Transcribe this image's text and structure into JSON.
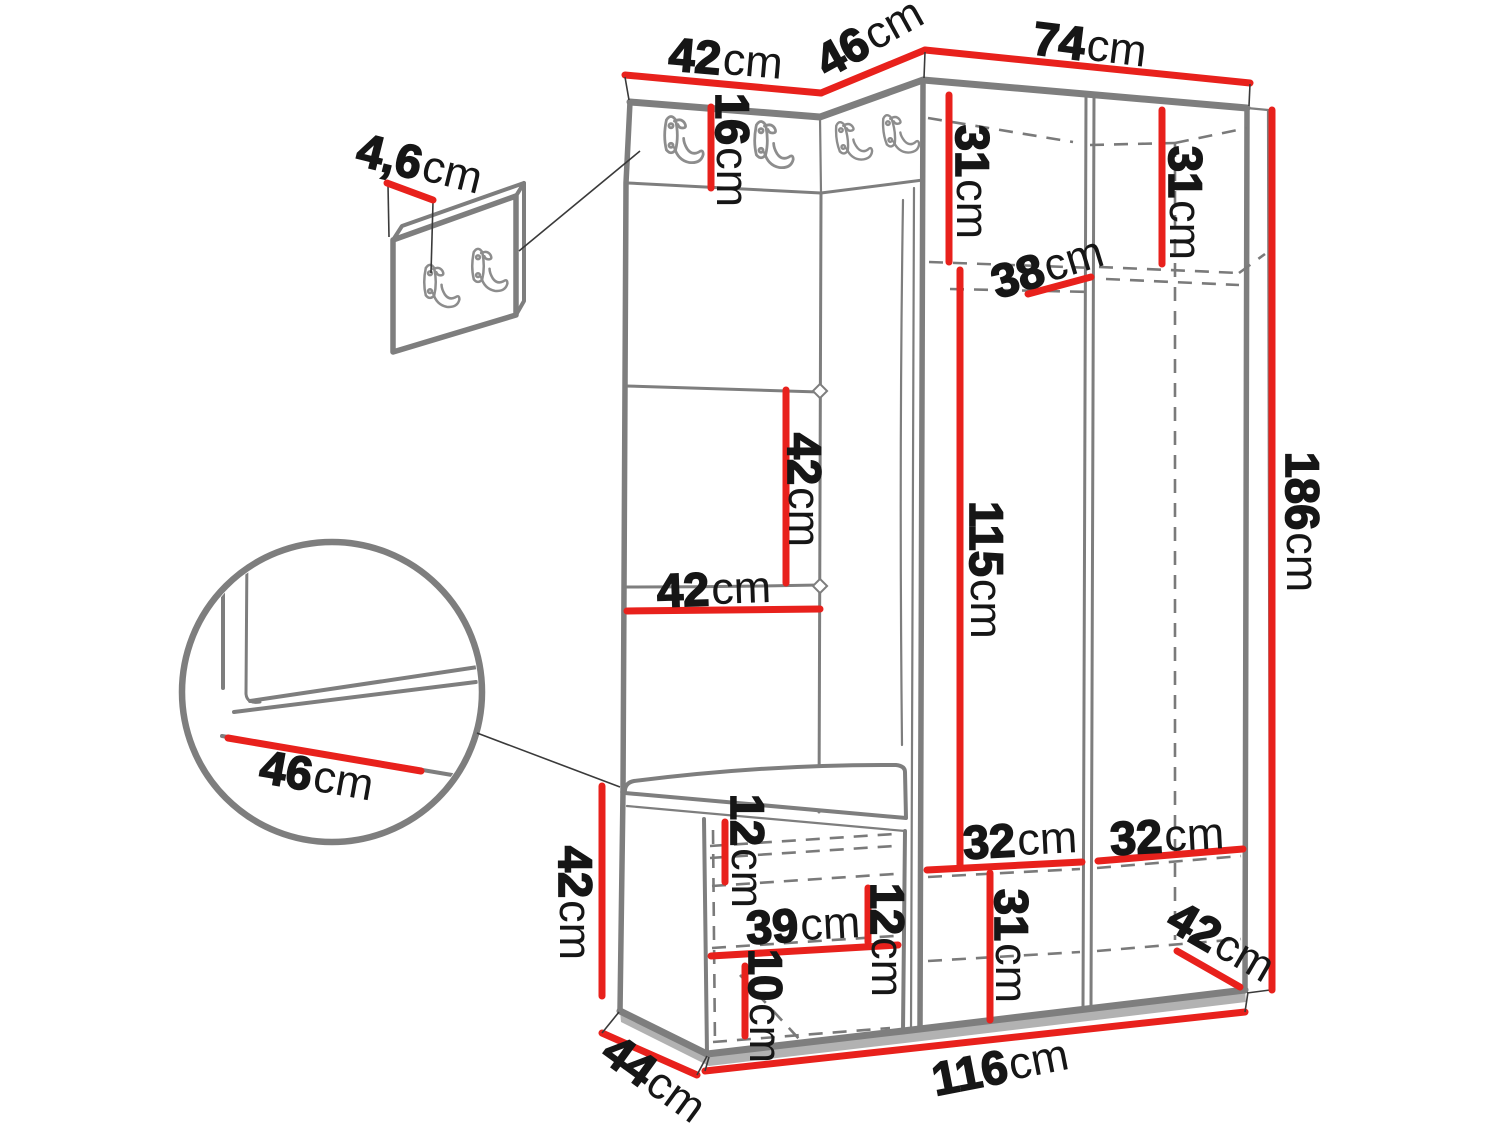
{
  "diagram": {
    "subject": "Hallway furniture set dimension drawing: corner wardrobe with upholstered panel, coat hook strip, wall hook panel, seat bench and shoe cabinet",
    "unit": "cm",
    "colors": {
      "dimension_line": "#e8211c",
      "outline_gray": "#7e7e7e",
      "dashed_gray": "#7a7a7a",
      "label_text": "#161616",
      "floor_shadow": "#b2b2b2",
      "background": "#ffffff"
    },
    "icons": {
      "coat_hook": "double-coat-hook-icon",
      "detail_circle": "magnified-corner-detail",
      "tuft_button": "upholstery-button-diamond"
    }
  },
  "dims": {
    "wall_panel_thickness": {
      "value": "4,6",
      "unit": "cm"
    },
    "left_section_top_width": {
      "value": "42",
      "unit": "cm"
    },
    "corner_section_top_width": {
      "value": "46",
      "unit": "cm"
    },
    "wardrobe_top_width": {
      "value": "74",
      "unit": "cm"
    },
    "hook_strip_height": {
      "value": "16",
      "unit": "cm"
    },
    "upper_left_compartment_height": {
      "value": "31",
      "unit": "cm"
    },
    "upper_right_compartment_height": {
      "value": "31",
      "unit": "cm"
    },
    "top_shelf_depth": {
      "value": "38",
      "unit": "cm"
    },
    "panel_square_height": {
      "value": "42",
      "unit": "cm"
    },
    "panel_width": {
      "value": "42",
      "unit": "cm"
    },
    "hanging_section_height": {
      "value": "115",
      "unit": "cm"
    },
    "total_height": {
      "value": "186",
      "unit": "cm"
    },
    "seat_depth_detail": {
      "value": "46",
      "unit": "cm"
    },
    "bench_height": {
      "value": "42",
      "unit": "cm"
    },
    "bench_top_gap": {
      "value": "12",
      "unit": "cm"
    },
    "bench_shelf_width": {
      "value": "39",
      "unit": "cm"
    },
    "bench_middle_gap": {
      "value": "12",
      "unit": "cm"
    },
    "bench_bottom_gap": {
      "value": "10",
      "unit": "cm"
    },
    "left_door_width": {
      "value": "32",
      "unit": "cm"
    },
    "right_door_width": {
      "value": "32",
      "unit": "cm"
    },
    "bottom_compartment_height": {
      "value": "31",
      "unit": "cm"
    },
    "wardrobe_depth": {
      "value": "42",
      "unit": "cm"
    },
    "bench_depth": {
      "value": "44",
      "unit": "cm"
    },
    "total_width": {
      "value": "116",
      "unit": "cm"
    }
  }
}
